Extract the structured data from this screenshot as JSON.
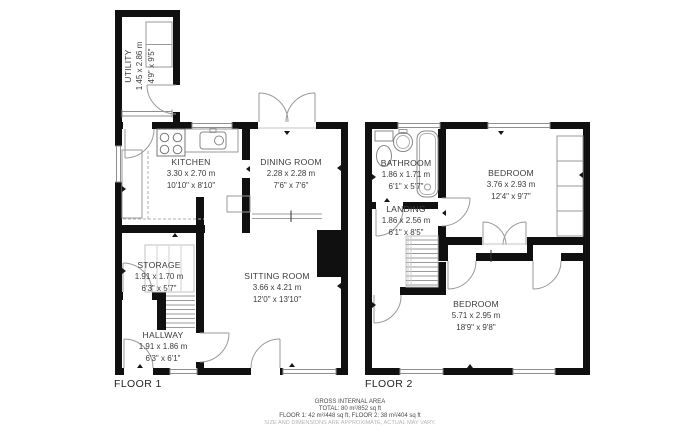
{
  "colors": {
    "wall": "#101010",
    "door_line": "#9a9a9a",
    "window_line": "#8f8f8f",
    "furniture_line": "#999999",
    "text": "#3c3c3c",
    "muted_text": "#b5b5b5"
  },
  "floors": [
    {
      "label": "FLOOR 1"
    },
    {
      "label": "FLOOR 2"
    }
  ],
  "rooms": [
    {
      "name": "UTILITY",
      "metric": "1.45 x 2.86 m",
      "imperial": "4'9\" x 9'5\""
    },
    {
      "name": "KITCHEN",
      "metric": "3.30 x 2.70 m",
      "imperial": "10'10\" x 8'10\""
    },
    {
      "name": "DINING ROOM",
      "metric": "2.28 x 2.28 m",
      "imperial": "7'6\" x 7'6\""
    },
    {
      "name": "SITTING ROOM",
      "metric": "3.66 x 4.21 m",
      "imperial": "12'0\" x 13'10\""
    },
    {
      "name": "STORAGE",
      "metric": "1.91 x 1.70 m",
      "imperial": "6'3\" x 5'7\""
    },
    {
      "name": "HALLWAY",
      "metric": "1.91 x 1.86 m",
      "imperial": "6'3\" x 6'1\""
    },
    {
      "name": "BATHROOM",
      "metric": "1.86 x 1.71 m",
      "imperial": "6'1\" x 5'7\""
    },
    {
      "name": "LANDING",
      "metric": "1.86 x 2.56 m",
      "imperial": "6'1\" x 8'5\""
    },
    {
      "name": "BEDROOM",
      "metric": "3.76 x 2.93 m",
      "imperial": "12'4\" x 9'7\""
    },
    {
      "name": "BEDROOM",
      "metric": "5.71 x 2.95 m",
      "imperial": "18'9\" x 9'8\""
    }
  ],
  "fixtures": [
    "stove",
    "sink",
    "toilet",
    "basin",
    "bathtub",
    "wardrobe",
    "stairs",
    "chimney-breast"
  ],
  "footer": {
    "line1": "GROSS INTERNAL AREA",
    "line2": "TOTAL: 80 m²/852 sq ft",
    "line3": "FLOOR 1: 42 m²/448 sq ft, FLOOR 2: 38 m²/404 sq ft",
    "disclaimer": "SIZE AND DIMENSIONS ARE APPROXIMATE, ACTUAL MAY VARY."
  }
}
